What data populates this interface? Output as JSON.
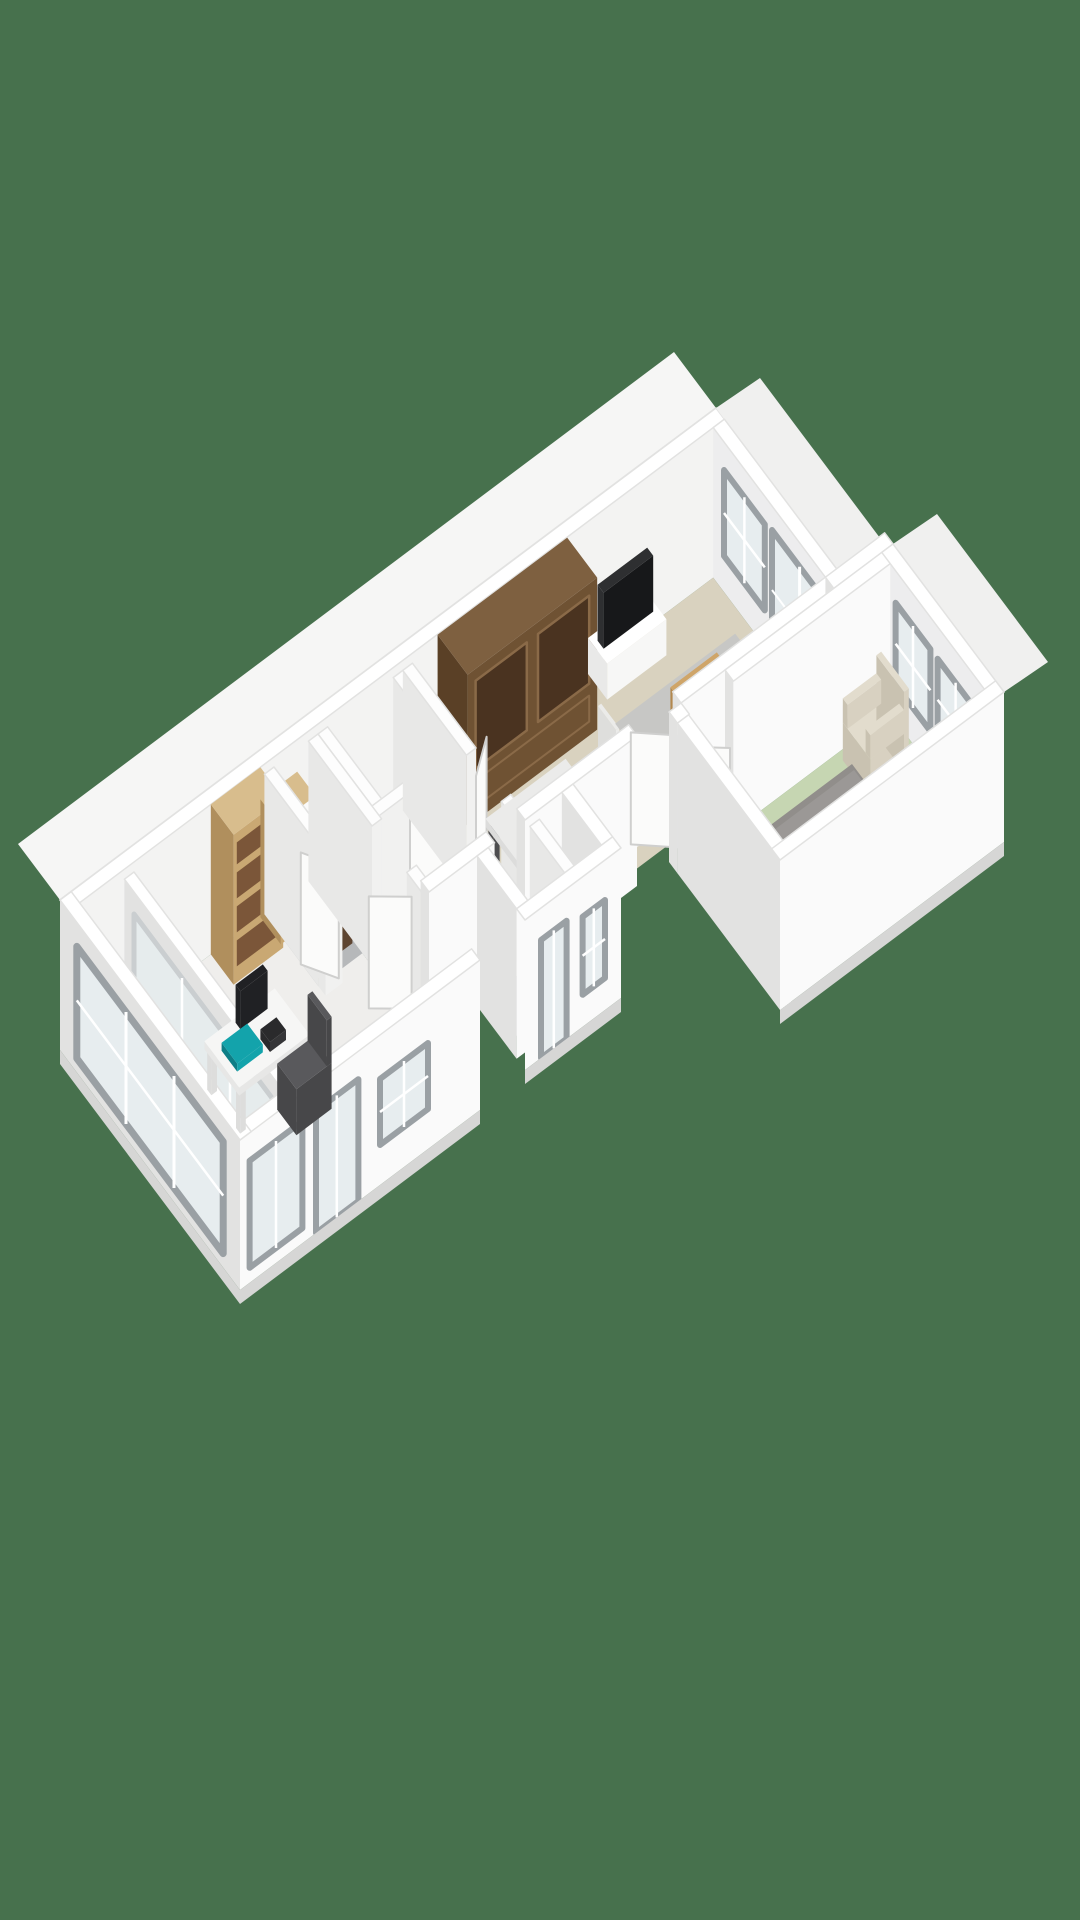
{
  "scene": {
    "description": "3D isometric floor plan of an apartment rendered on a solid green background, no text labels",
    "rooms": [
      "living-room",
      "dining-area",
      "bedroom",
      "office",
      "loggia",
      "hallway",
      "bathroom",
      "wc",
      "entry-hall"
    ],
    "furniture": [
      "armoire",
      "tv",
      "tv-stand",
      "rug",
      "coffee-table",
      "dining-table",
      "dining-chair",
      "bed",
      "pillow",
      "armchair",
      "side-table",
      "desk",
      "desk-chair",
      "monitor",
      "laptop",
      "bookshelf",
      "dresser",
      "toilet",
      "pipe-column"
    ],
    "colors": {
      "background": "#47714d",
      "walls": {
        "top": "#ffffff",
        "edge": "#e2e2e1",
        "face_se": "#fafafa",
        "face_sw": "#e2e2e1",
        "inner_nw": "#f3f3f2",
        "inner_ne": "#ededee",
        "int_face_se": "#f1f1f0",
        "int_face_sw": "#e8e8e7",
        "int_top": "#fdfdfd",
        "band": "#f6f6f5",
        "band_ne": "#f0f0ef",
        "slab": "#d6d6d5"
      },
      "window": {
        "frame": "#9aa0a4",
        "frame_light": "#c8cdcf",
        "glass": "#e7edef",
        "door_white": "#fbfbfa",
        "door_edge": "#cfcfce"
      },
      "floors": {
        "living": "#d9d2bf",
        "bedroom": "#c6d6b2",
        "office": "#efeeec",
        "loggia": "#e3dcc7",
        "bath": "#babcbe",
        "wc": "#b6b8ba",
        "hall": "#f2f1ee",
        "entry": "#c2c4c5"
      },
      "furniture": {
        "armoire_sw": "#5a4026",
        "armoire_se": "#6f5233",
        "armoire_top": "#7e6040",
        "armoire_panel": "#4a3320",
        "armoire_frame": "#8a6a48",
        "shelf_oak": "#c9a873",
        "shelf_oak_dark": "#b08f5d",
        "shelf_oak_top": "#d8bd8d",
        "books": "#7b5639",
        "books2": "#5d4733",
        "dresser_sw": "#4e3826",
        "dresser_se": "#5e4531",
        "dresser_top": "#6d5540",
        "tv_screen": "#17181a",
        "tv_edge": "#2e2f31",
        "tv_stand": "#f7f7f6",
        "tv_stand_sw": "#e9e9e8",
        "rug": "#c7c7c5",
        "coffee_sw": "#b2884f",
        "coffee_se": "#c29659",
        "coffee_top": "#cfa569",
        "table_top": "#ebebea",
        "table_side": "#dcdcdb",
        "table_leg": "#4d4d4f",
        "chair": "#ebebe9",
        "chair_sw": "#dededc",
        "bed_sw": "#76736f",
        "bed_se": "#858280",
        "bed_top": "#918e8b",
        "duvet": "#9b9896",
        "pillow": "#d6d4d0",
        "pillow_sw": "#c2c0bc",
        "armchair": "#d8d1c1",
        "armchair_sw": "#c9c2b1",
        "armchair_top": "#e2dccd",
        "sidetable_top": "#e4e8da",
        "sidetable_side": "#d6dbc9",
        "sidetable_stripe": "#c2cbb2",
        "desk_top": "#f6f6f5",
        "desk_side": "#e7e7e6",
        "desk_leg": "#dddddc",
        "monitor": "#202124",
        "laptop": "#13a3ab",
        "laptop_dark": "#0d7e86",
        "desk_chair": "#474749",
        "desk_chair_top": "#59595c",
        "toilet": "#f4f4f3",
        "toilet_sw": "#e6e6e5",
        "toilet_top": "#ffffff",
        "column": "#ededec",
        "column_sw": "#e0e0df",
        "column_top": "#fafafa"
      }
    }
  }
}
